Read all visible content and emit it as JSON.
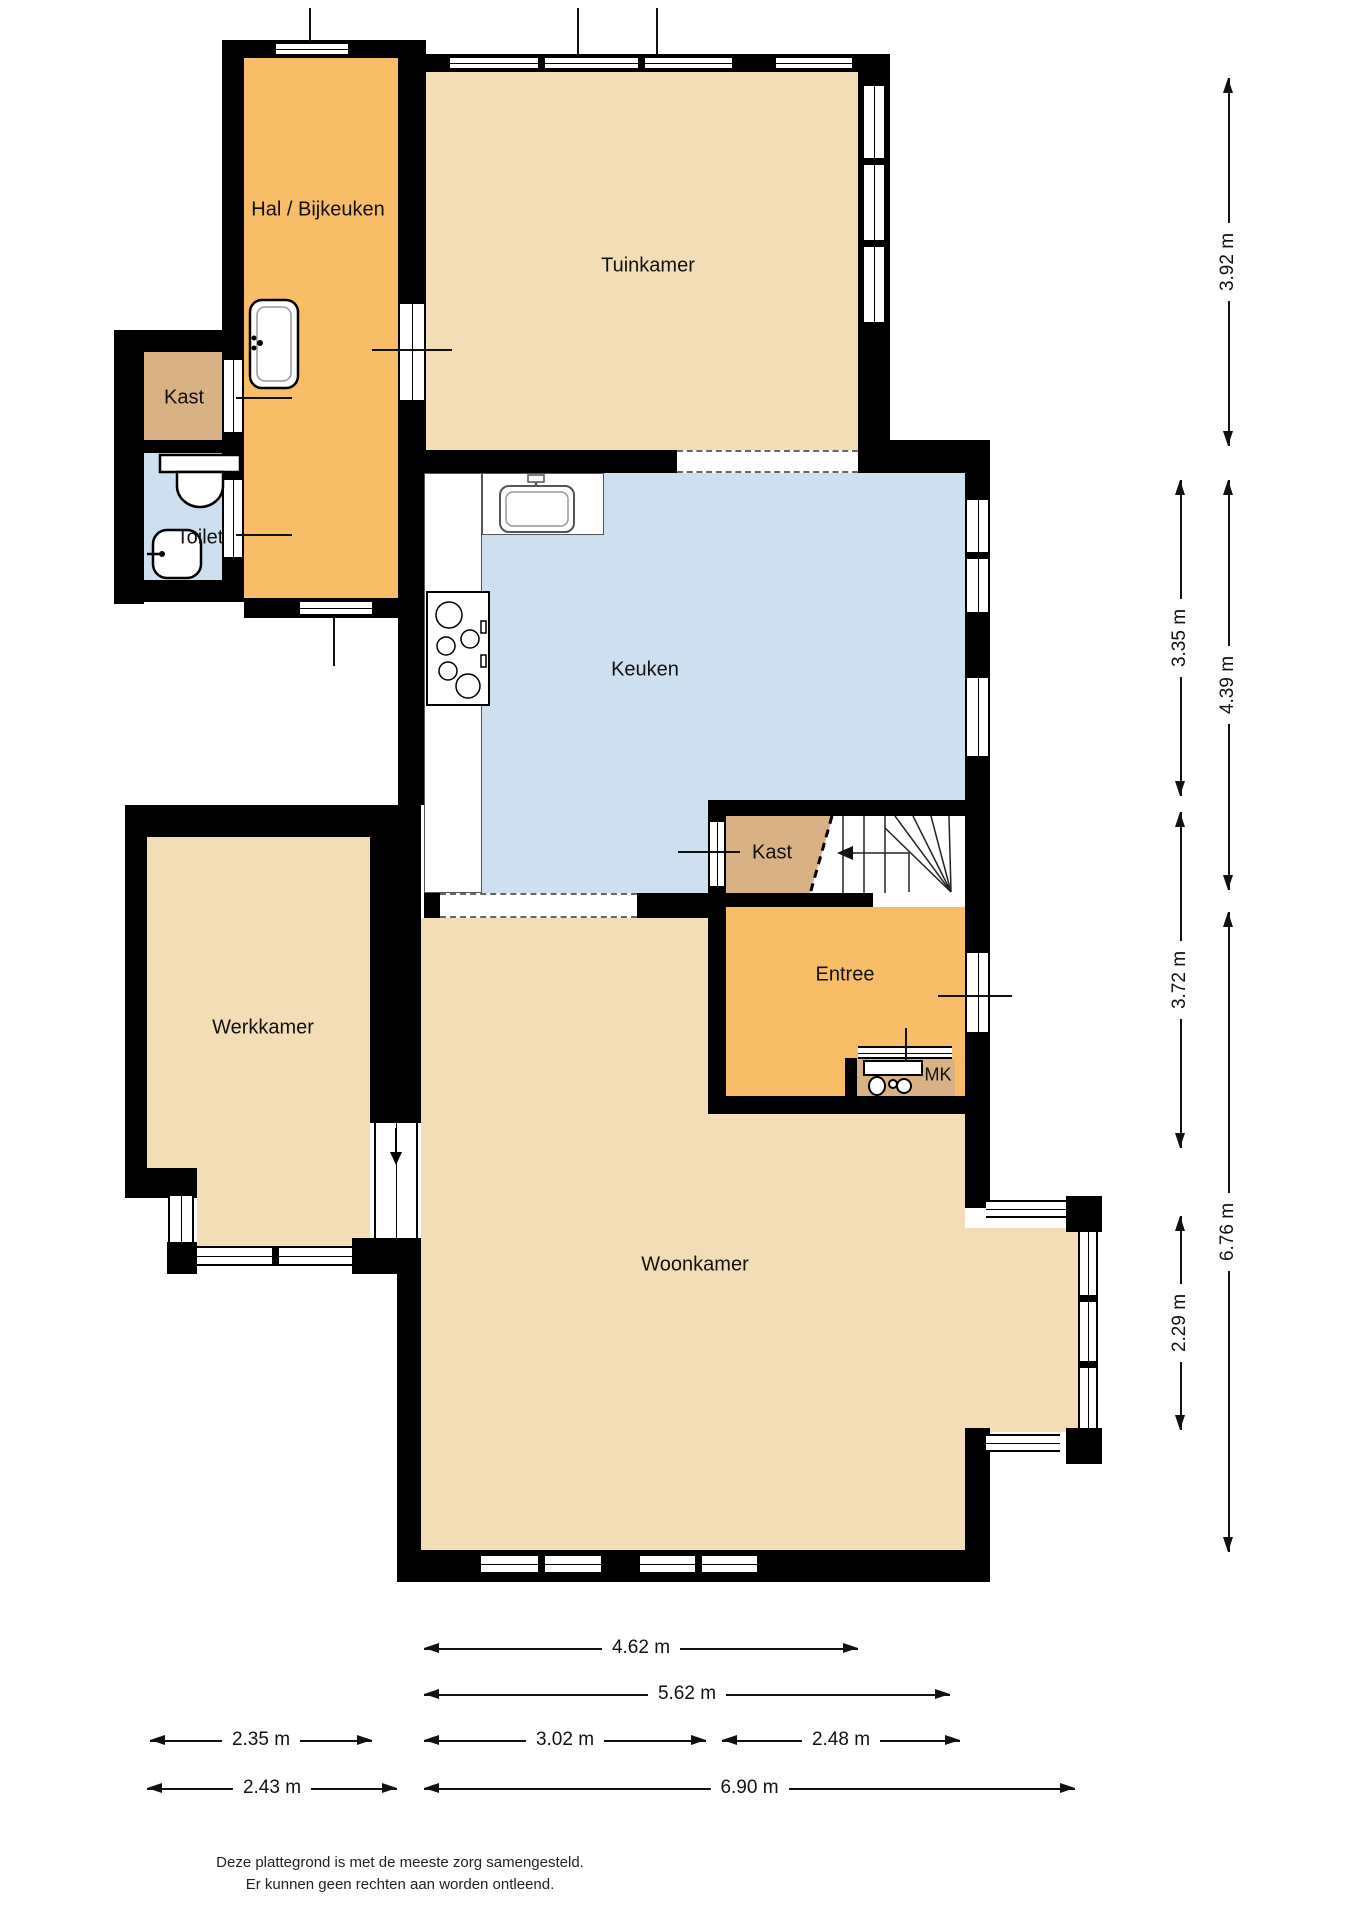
{
  "plan": {
    "title": "Begane grond plattegrond",
    "rooms": {
      "hal": {
        "label": "Hal / Bijkeuken"
      },
      "tuinkamer": {
        "label": "Tuinkamer"
      },
      "kast_hal": {
        "label": "Kast"
      },
      "toilet": {
        "label": "Toilet"
      },
      "keuken": {
        "label": "Keuken"
      },
      "kast_trap": {
        "label": "Kast"
      },
      "entree": {
        "label": "Entree"
      },
      "meterkast": {
        "label": "MK"
      },
      "werkkamer": {
        "label": "Werkkamer"
      },
      "woonkamer": {
        "label": "Woonkamer"
      }
    },
    "fixtures": {
      "hal_sink": "sink-icon",
      "toilet_bowl": "toilet-icon",
      "toilet_basin": "hand-basin-icon",
      "kitchen_sink": "kitchen-sink-icon",
      "stove": "stove-icon",
      "stairs": "stairs-icon",
      "stairs_direction": "arrow-left-icon",
      "meter_panel": "meters-icon",
      "door_slide": "arrow-down-icon"
    }
  },
  "dimensions": {
    "vertical": [
      {
        "id": "tuinkamer-height",
        "label": "3.92 m"
      },
      {
        "id": "keuken-height",
        "label": "3.35 m"
      },
      {
        "id": "keuken-trap-height",
        "label": "4.39 m"
      },
      {
        "id": "entree-height",
        "label": "3.72 m"
      },
      {
        "id": "woonkamer-height",
        "label": "6.76 m"
      },
      {
        "id": "erker-height",
        "label": "2.29 m"
      }
    ],
    "horizontal": [
      {
        "id": "tuinkamer-width",
        "label": "4.62 m"
      },
      {
        "id": "keuken-width",
        "label": "5.62 m"
      },
      {
        "id": "werkkamer-width",
        "label": "2.35 m"
      },
      {
        "id": "keuken-links-width",
        "label": "3.02 m"
      },
      {
        "id": "entree-width",
        "label": "2.48 m"
      },
      {
        "id": "werkkamer-buiten-width",
        "label": "2.43 m"
      },
      {
        "id": "woonkamer-width",
        "label": "6.90 m"
      }
    ]
  },
  "footer": {
    "line1": "Deze plattegrond is met de meeste zorg samengesteld.",
    "line2": "Er kunnen geen rechten aan worden ontleend."
  },
  "colors": {
    "room_orange": "#F7BE67",
    "room_beige": "#F2DDB7",
    "room_tan": "#D8B185",
    "room_blue": "#CEDFEF",
    "wall": "#000000"
  }
}
